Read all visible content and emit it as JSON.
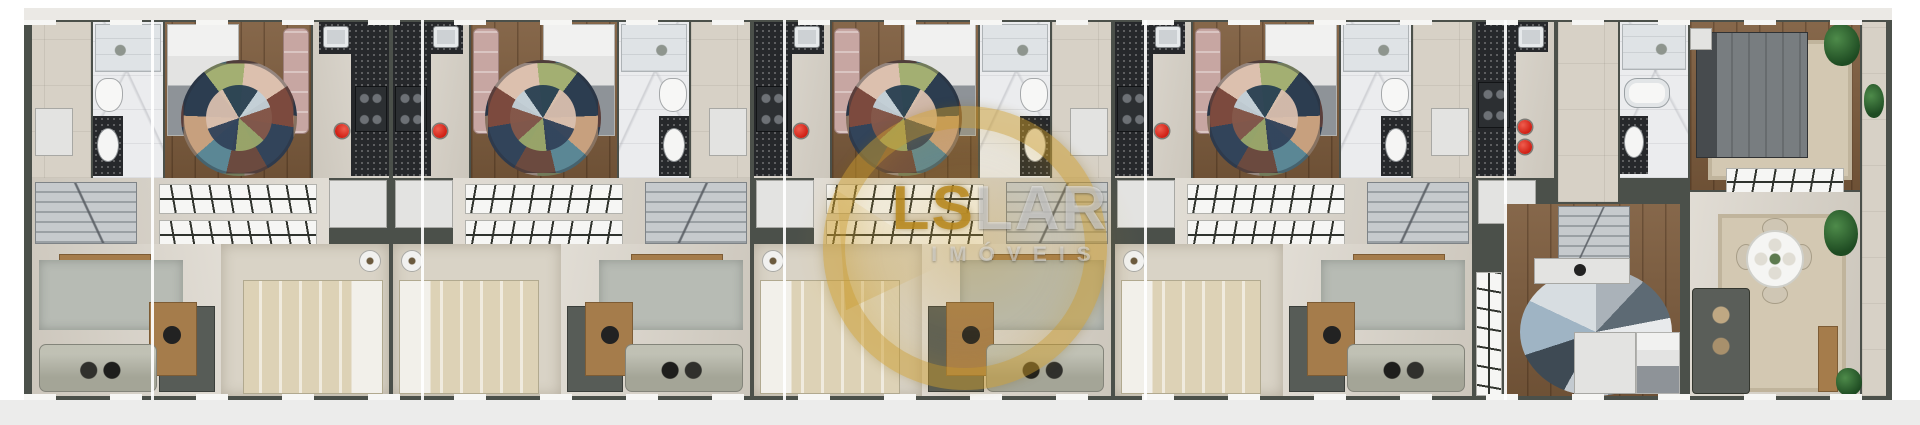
{
  "watermark": {
    "brand_bold": "LS",
    "brand_light": "LAR",
    "subtitle": "IMÓVEIS",
    "ring_color": "#c99b2f"
  },
  "units": [
    {
      "id": "unit-1",
      "mirrored": true,
      "rooms": [
        "bedroom",
        "bathroom",
        "hall",
        "kitchen",
        "closet",
        "staircase",
        "lower-bedroom",
        "living-room"
      ]
    },
    {
      "id": "unit-2",
      "mirrored": false,
      "rooms": [
        "kitchen",
        "bedroom",
        "bathroom",
        "hall",
        "closet",
        "staircase",
        "lower-bedroom",
        "living-room"
      ]
    },
    {
      "id": "unit-3",
      "mirrored": false,
      "rooms": [
        "kitchen",
        "bedroom",
        "bathroom",
        "hall",
        "closet",
        "staircase",
        "lower-bedroom",
        "living-room"
      ]
    },
    {
      "id": "unit-4",
      "mirrored": false,
      "rooms": [
        "kitchen",
        "bedroom",
        "bathroom",
        "hall",
        "closet",
        "staircase",
        "lower-bedroom",
        "living-room"
      ]
    },
    {
      "id": "end-unit",
      "end": true,
      "rooms": [
        "kitchen",
        "bathroom",
        "bedroom",
        "closet",
        "staircase",
        "dining-area",
        "living-room",
        "balcony"
      ]
    }
  ],
  "colors": {
    "wall": "#4b504a",
    "wood_floor": "#7d5c3d",
    "marble_bath": "#ebecee",
    "beige_floor": "#d7d1c6",
    "carpet": "#d9d3c6",
    "kitchen_counter": "#26282b",
    "accent_red_stool": "#d01f14",
    "watermark_gold": "#c99b2f",
    "exterior_band": "#ebe9e5",
    "page_background": "#ffffff"
  }
}
